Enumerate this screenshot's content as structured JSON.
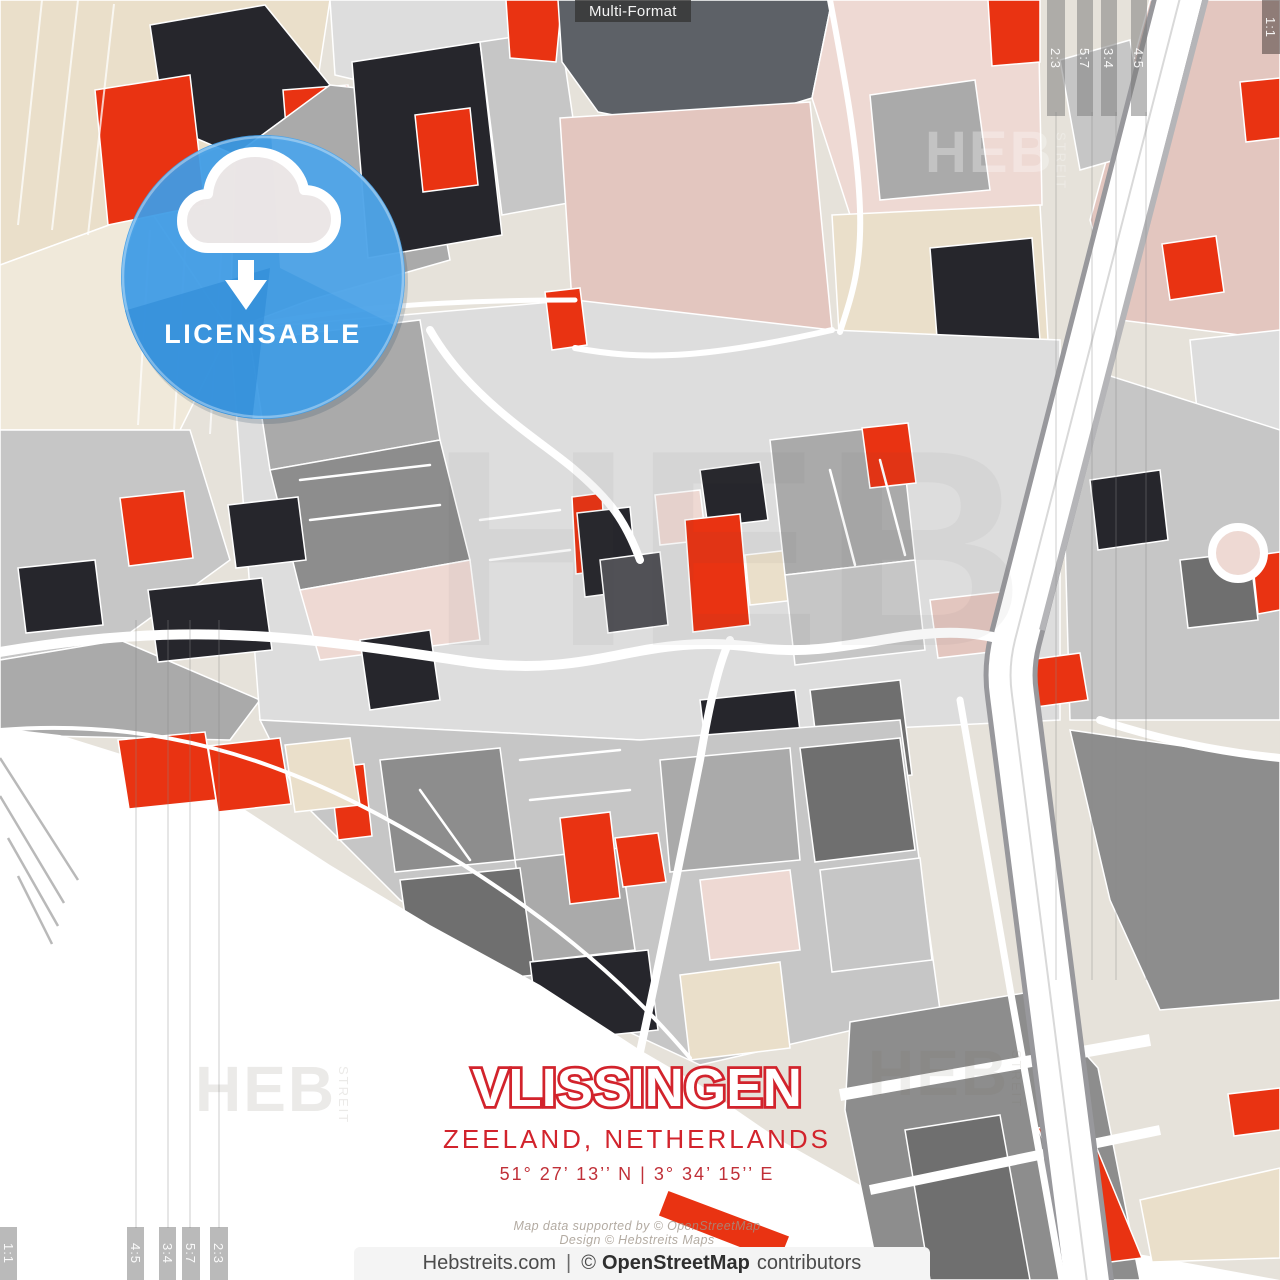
{
  "top_label": {
    "text": "Multi-Format"
  },
  "license_badge": {
    "label": "LICENSABLE",
    "icon": "cloud-download-icon"
  },
  "crop_ratios": {
    "top_right": [
      "2:3",
      "5:7",
      "3:4",
      "4:5"
    ],
    "top_right_corner": "1:1",
    "bottom_left": [
      "1:1",
      "4:5",
      "3:4",
      "5:7",
      "2:3"
    ]
  },
  "title_block": {
    "city": "VLISSINGEN",
    "region": "ZEELAND, NETHERLANDS",
    "coordinates": "51°  27’  13’’ N  |  3°  34’  15’’ E"
  },
  "credits": {
    "line1": "Map data supported by © OpenStreetMap",
    "line2": "Design © Hebstreits Maps"
  },
  "footer": {
    "site": "Hebstreits.com",
    "separator": "|",
    "copyright": "©",
    "osm": "OpenStreetMap",
    "suffix": "contributors"
  },
  "watermark": {
    "text": "HEB",
    "vertical": "STREIT"
  },
  "map": {
    "palette": {
      "bg": "#e6e2da",
      "sea": "#ffffff",
      "beige": "#eadfca",
      "beige2": "#f0e9da",
      "pink": "#e3c6bf",
      "pink2": "#eed9d3",
      "red": "#e93312",
      "charcoal": "#26262c",
      "slate": "#5d6167",
      "g1": "#f2f2f2",
      "g2": "#dddddd",
      "g3": "#c6c6c6",
      "g4": "#aaaaaa",
      "g5": "#8d8d8d",
      "g6": "#6f6f6f",
      "g7": "#515156",
      "road": "#ffffff",
      "badge-blue": "#3f9de7",
      "badge-blue-dark": "#2b89d6",
      "title-red": "#d2232c",
      "coord-red": "#c03038"
    }
  }
}
